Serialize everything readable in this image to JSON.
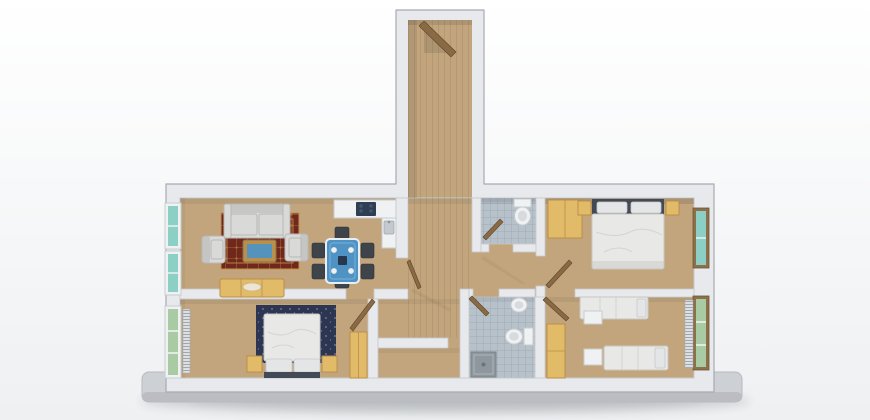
{
  "meta": {
    "description": "3D rendered top-down floor plan of an apartment on a plain light background, standing on a grey base slab with a soft shadow",
    "render_style": "architectural 3d dollhouse view",
    "visible_text": ""
  },
  "palette": {
    "page_bg_top": "#ffffff",
    "page_bg_bottom": "#eef0f2",
    "slab": "#cdd0d4",
    "slab_edge": "#b7babf",
    "wall": "#e7e9ec",
    "wall_shade": "#c7cace",
    "wall_line": "#a6abb1",
    "floor": "#c2a57d",
    "tile": "#b7c1c9",
    "tile_line": "#97a4ae",
    "carpet": "#6e241a",
    "carpet_accent": "#c2904a",
    "rug_navy": "#2c3551",
    "wood": "#e2bb69",
    "wood_dark": "#b98f49",
    "frame_wood": "#8d6f49",
    "fabric_light": "#d9dad8",
    "fabric_shade": "#b7b8b6",
    "bed_linen": "#e8e8e6",
    "bed_shadow": "#c6c6c2",
    "pillow": "#e4e5e7",
    "headboard": "#424a56",
    "glass_teal": "#8ccfc5",
    "glass_green": "#a9cba4",
    "glass_blue": "#4f93c4",
    "chair_dark": "#3f444b",
    "cooktop": "#2e3e54",
    "fixture": "#f0f1f2",
    "fixture_shade": "#c9cdd0",
    "shower": "#8f979e",
    "door": "#8a6a44",
    "shadow": "#1c2026"
  },
  "scene": {
    "rooms": {
      "entrance": {
        "label": "Entrance hall with open front door",
        "floor": "wood"
      },
      "living": {
        "label": "Living and dining room with open kitchen",
        "floor": "wood",
        "furniture": [
          "sofa",
          "left armchair",
          "right armchair",
          "coffee table with blue glass top",
          "red oriental rug",
          "wooden sideboard",
          "blue glass dining table",
          "six dark chairs",
          "kitchen counter with dark cooktop",
          "sink unit"
        ],
        "windows": 2
      },
      "wc": {
        "label": "Guest WC with toilet",
        "floor": "tile"
      },
      "master": {
        "label": "Master bedroom with double bed, two nightstands and wardrobe",
        "floor": "wood",
        "windows": 1
      },
      "hall": {
        "label": "Hallway",
        "floor": "wood"
      },
      "second": {
        "label": "Second bedroom with double bed on navy rug, nightstands, wardrobe and radiator",
        "floor": "wood",
        "windows": 1
      },
      "bath": {
        "label": "Bathroom with washbasin, toilet and shower",
        "floor": "tile"
      },
      "twin": {
        "label": "Twin bedroom with two single beds, white nightstands, wardrobe and radiator",
        "floor": "wood",
        "windows": 1
      },
      "storage": {
        "label": "Storage closet",
        "floor": "wood"
      }
    }
  }
}
